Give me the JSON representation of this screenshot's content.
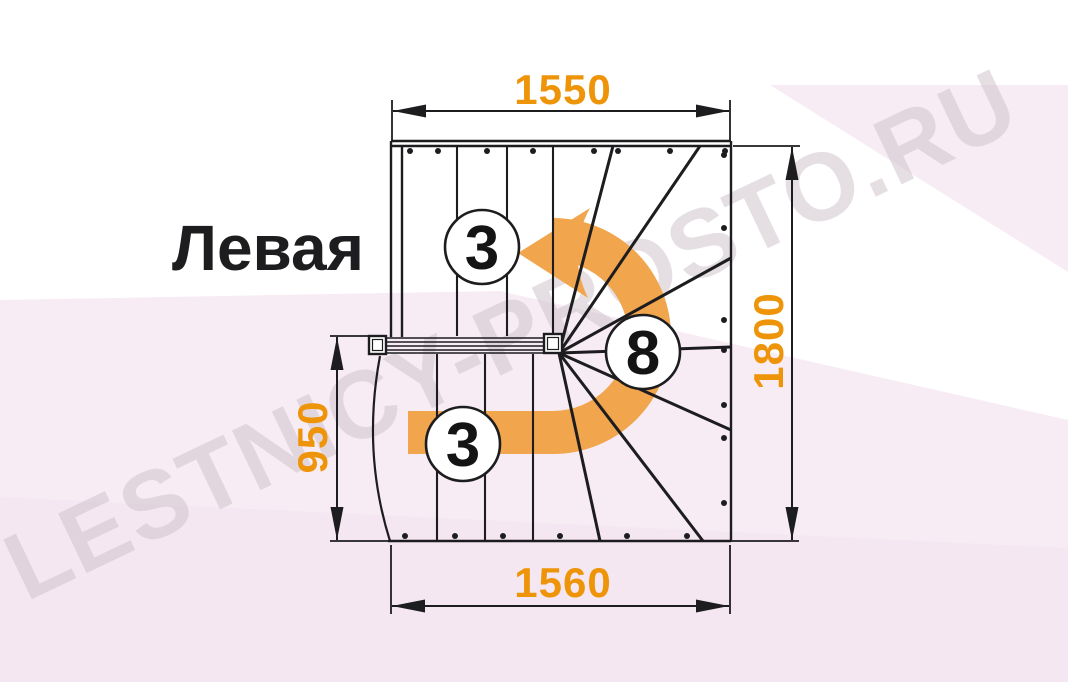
{
  "labels": {
    "orientation": "Левая",
    "dim_top": "1550",
    "dim_right": "1800",
    "dim_left": "950",
    "dim_bottom": "1560",
    "steps_top_flight": "3",
    "steps_winder": "8",
    "steps_bottom_flight": "3"
  },
  "watermark": {
    "text": "LESTNICY-PROSTO.RU"
  },
  "colors": {
    "dimension_text": "#ee9408",
    "arrow_fill": "#f1a54c",
    "line": "#1d1d1f",
    "circle_fill": "#ffffff",
    "wedge_fill": "#f7ecf4",
    "wedge_fill_deep": "#f2e4ee"
  },
  "drawing": {
    "width": 1068,
    "height": 682,
    "wedges": [
      {
        "points": "0,300 500,291 1068,420 1068,682 0,682",
        "fill": "#f7ecf4",
        "opacity": 1
      },
      {
        "points": "770,85 1068,85 1068,272",
        "fill": "#f7ecf4",
        "opacity": 1
      },
      {
        "points": "0,497 1068,548 1068,682 0,682",
        "fill": "#f2e4ee",
        "opacity": 0.55
      }
    ],
    "outline": [
      [
        391,
        141,
        731,
        141
      ],
      [
        391,
        146,
        731,
        146
      ],
      [
        731,
        141,
        731,
        541
      ],
      [
        388,
        541,
        731,
        541
      ],
      [
        391,
        141,
        391,
        337
      ],
      [
        402,
        146,
        402,
        337
      ]
    ],
    "risers_top": [
      [
        457,
        146,
        457,
        336
      ],
      [
        507,
        146,
        507,
        336
      ],
      [
        553,
        146,
        553,
        334
      ]
    ],
    "risers_bottom": [
      [
        437,
        354,
        437,
        541
      ],
      [
        485,
        354,
        485,
        541
      ],
      [
        533,
        354,
        533,
        541
      ]
    ],
    "fan": {
      "center": [
        559,
        353
      ],
      "targets": [
        [
          613,
          146
        ],
        [
          700,
          146
        ],
        [
          731,
          258
        ],
        [
          731,
          347
        ],
        [
          731,
          430
        ],
        [
          703,
          541
        ],
        [
          600,
          541
        ]
      ]
    },
    "rail": {
      "x1": 387,
      "x2": 544,
      "ys": [
        338,
        342,
        346,
        350,
        353
      ]
    },
    "posts": [
      {
        "x": 369,
        "y": 336,
        "w": 17,
        "h": 18
      },
      {
        "x": 544,
        "y": 334,
        "w": 18,
        "h": 19
      }
    ],
    "curved_stringer": "M 380 356 Q 362 452 390 541",
    "dots": {
      "r": 3,
      "top": {
        "y": 151,
        "xs": [
          410,
          438,
          487,
          533,
          594,
          618,
          670,
          725
        ]
      },
      "right": {
        "x": 724,
        "ys": [
          155,
          228,
          320,
          350,
          405,
          438,
          503
        ]
      },
      "bottom": {
        "y": 536,
        "xs": [
          405,
          455,
          503,
          560,
          627,
          687
        ]
      }
    },
    "extensions": [
      [
        392,
        100,
        392,
        140
      ],
      [
        730,
        100,
        730,
        140
      ],
      [
        391,
        545,
        391,
        614
      ],
      [
        730,
        545,
        730,
        614
      ],
      [
        733,
        146,
        800,
        146
      ],
      [
        731,
        541,
        799,
        541
      ],
      [
        330,
        541,
        388,
        541
      ],
      [
        330,
        336,
        369,
        336
      ]
    ],
    "dim_lines": [
      [
        393,
        111,
        729,
        111
      ],
      [
        392,
        606,
        729,
        606
      ],
      [
        792,
        147,
        792,
        540
      ],
      [
        337,
        337,
        337,
        540
      ]
    ],
    "dim_arrows": [
      {
        "tip": [
          393,
          111
        ],
        "dir": "left"
      },
      {
        "tip": [
          729,
          111
        ],
        "dir": "right"
      },
      {
        "tip": [
          392,
          606
        ],
        "dir": "left"
      },
      {
        "tip": [
          729,
          606
        ],
        "dir": "right"
      },
      {
        "tip": [
          792,
          147
        ],
        "dir": "up"
      },
      {
        "tip": [
          792,
          540
        ],
        "dir": "down"
      },
      {
        "tip": [
          337,
          337
        ],
        "dir": "up"
      },
      {
        "tip": [
          337,
          540
        ],
        "dir": "down"
      }
    ],
    "arrow": {
      "band": "M 408 411 L 553 411 A 75 75 0 0 0 553 261 L 553 218 A 118 118 0 0 1 553 454 L 408 454 Z",
      "head": "M 518 253 L 590 208 Q 566 252 588 298 Z"
    },
    "circles": [
      {
        "cx": 482,
        "cy": 247,
        "r": 37
      },
      {
        "cx": 643,
        "cy": 352,
        "r": 37
      },
      {
        "cx": 463,
        "cy": 444,
        "r": 37
      }
    ],
    "stroke": {
      "outline": 2.4,
      "riser": 2.1,
      "fan": 3,
      "rail": 1.6,
      "ext": 1.8,
      "dim": 2,
      "circle": 2.6,
      "arc": 2.2,
      "post": 2.4
    }
  }
}
